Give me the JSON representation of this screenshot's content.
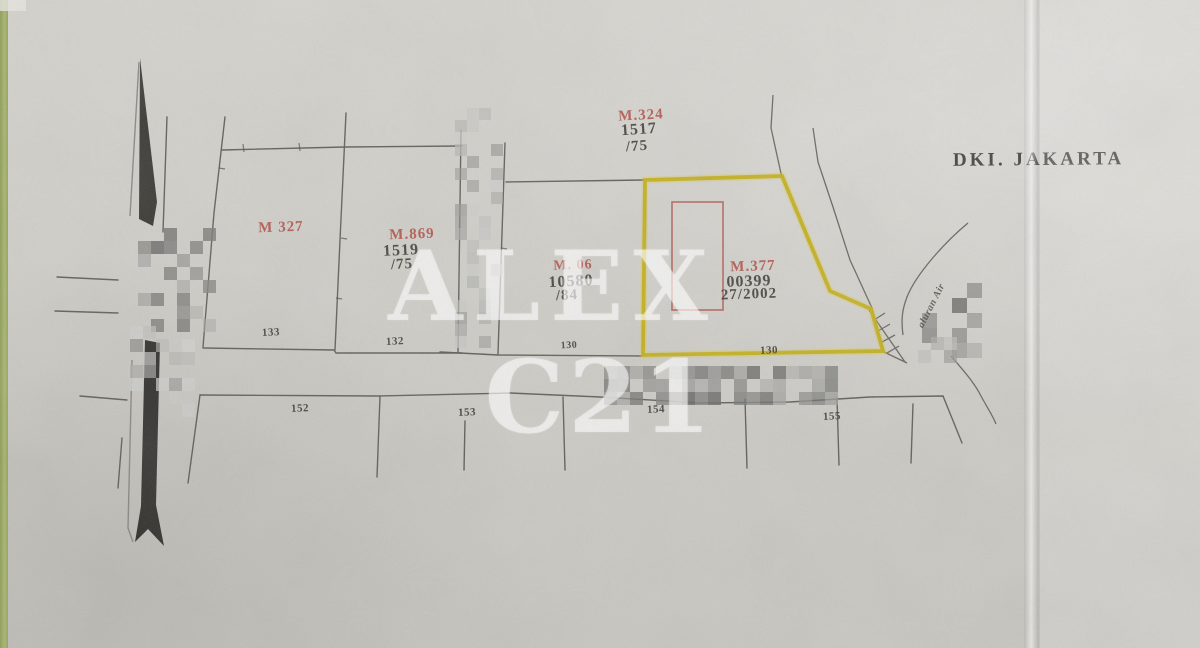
{
  "document": {
    "region_stamp": "DKI. JAKARTA"
  },
  "watermark": {
    "line1": "ALEX",
    "line2": "C21"
  },
  "map_labels": {
    "red": [
      {
        "text": "M.324",
        "x": 641,
        "y": 116,
        "size": 15,
        "rot": -3
      },
      {
        "text": "M 327",
        "x": 281,
        "y": 228,
        "size": 15,
        "rot": -2
      },
      {
        "text": "M.869",
        "x": 412,
        "y": 235,
        "size": 15,
        "rot": -2
      },
      {
        "text": "M. 06",
        "x": 573,
        "y": 266,
        "size": 14,
        "rot": -2
      },
      {
        "text": "M.377",
        "x": 753,
        "y": 267,
        "size": 15,
        "rot": -2
      }
    ],
    "dark": [
      {
        "text": "1517",
        "x": 639,
        "y": 130,
        "size": 16,
        "rot": -4
      },
      {
        "text": "/75",
        "x": 637,
        "y": 147,
        "size": 15,
        "rot": -4
      },
      {
        "text": "1519",
        "x": 401,
        "y": 251,
        "size": 16,
        "rot": -3
      },
      {
        "text": "/75",
        "x": 402,
        "y": 265,
        "size": 15,
        "rot": -3
      },
      {
        "text": "10580",
        "x": 571,
        "y": 282,
        "size": 16,
        "rot": -3
      },
      {
        "text": "/84",
        "x": 567,
        "y": 296,
        "size": 15,
        "rot": -3
      },
      {
        "text": "00399",
        "x": 749,
        "y": 282,
        "size": 16,
        "rot": -2
      },
      {
        "text": "27/2002",
        "x": 749,
        "y": 295,
        "size": 15,
        "rot": -2
      }
    ],
    "plot_numbers": [
      {
        "text": "133",
        "x": 271,
        "y": 333,
        "size": 11,
        "rot": -3
      },
      {
        "text": "132",
        "x": 395,
        "y": 342,
        "size": 11,
        "rot": -3
      },
      {
        "text": "130",
        "x": 569,
        "y": 346,
        "size": 10,
        "rot": -3
      },
      {
        "text": "130",
        "x": 769,
        "y": 351,
        "size": 11,
        "rot": -2
      },
      {
        "text": "152",
        "x": 300,
        "y": 409,
        "size": 11,
        "rot": -2
      },
      {
        "text": "153",
        "x": 467,
        "y": 413,
        "size": 11,
        "rot": -2
      },
      {
        "text": "154",
        "x": 656,
        "y": 410,
        "size": 11,
        "rot": -2
      },
      {
        "text": "155",
        "x": 832,
        "y": 417,
        "size": 11,
        "rot": -3
      }
    ],
    "street": [
      {
        "text": "aluran Air",
        "x": 932,
        "y": 306,
        "size": 10,
        "rot": -63
      }
    ]
  },
  "colors": {
    "highlight_yellow": "#c3af1d",
    "parcel_outline_red": "#ad4f46",
    "ink": "#504e48",
    "red_stamp": "#b04a40",
    "paper": "#d2d0ca",
    "green_edge": "#9dab64"
  },
  "redactions": [
    {
      "x": 455,
      "y": 108,
      "w": 46,
      "h": 240,
      "cell": 12,
      "density": 0.42,
      "dark": false,
      "seed": 11
    },
    {
      "x": 138,
      "y": 228,
      "w": 66,
      "h": 96,
      "cell": 13,
      "density": 0.5,
      "dark": true,
      "seed": 23
    },
    {
      "x": 130,
      "y": 326,
      "w": 60,
      "h": 84,
      "cell": 13,
      "density": 0.45,
      "dark": false,
      "seed": 37
    },
    {
      "x": 604,
      "y": 366,
      "w": 232,
      "h": 36,
      "cell": 13,
      "density": 0.82,
      "dark": true,
      "seed": 53
    },
    {
      "x": 922,
      "y": 283,
      "w": 58,
      "h": 70,
      "cell": 15,
      "density": 0.35,
      "dark": true,
      "seed": 71
    },
    {
      "x": 905,
      "y": 337,
      "w": 52,
      "h": 16,
      "cell": 13,
      "density": 0.5,
      "dark": false,
      "seed": 83
    }
  ]
}
